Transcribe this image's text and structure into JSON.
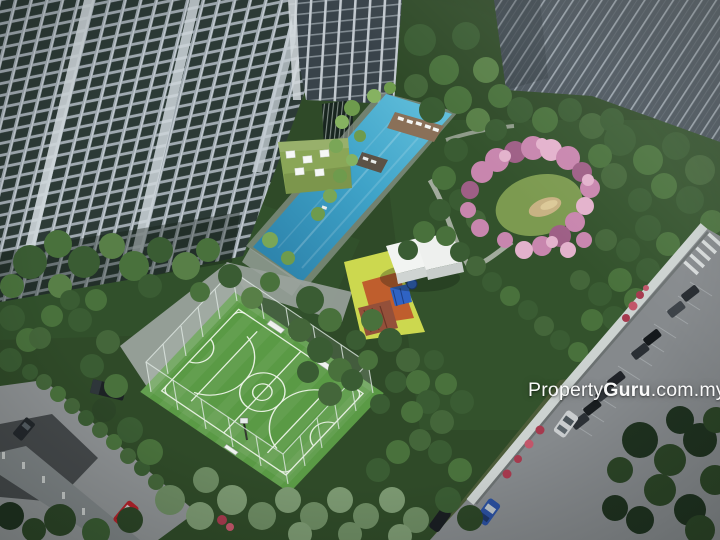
{
  "watermark": {
    "property": "Property",
    "guru": "Guru",
    "suffix": ".com.my"
  },
  "scene": {
    "type": "aerial-architectural-render",
    "description": "Aerial 3D render of a condominium facilities podium: residential towers, diagonal lap pool with sun deck, rooftop terrace with white cabanas, heart-shaped pink blossom garden with sand mound, playground with pavilions, fenced green futsal/basketball court, all ringed by trees and access roads with parked cars",
    "objects": [
      "residential-towers",
      "lap-pool",
      "sun-deck",
      "rooftop-terrace",
      "cabanas",
      "futsal-basketball-court",
      "chain-link-fence",
      "goal-benches",
      "basketball-hoop",
      "playground",
      "clubhouse-pavilions",
      "blossom-garden",
      "sand-mound",
      "boundary-wall",
      "access-roads",
      "zebra-crossing",
      "parked-cars",
      "flower-beds",
      "trees"
    ],
    "colors": {
      "pool": "#3fa3c8",
      "pool_deep": "#2e85ad",
      "court_turf": "#5a9a45",
      "court_lines": "#edf4e8",
      "blossom": "#c886ae",
      "tree": "#3a5c33",
      "tree_dark": "#24381f",
      "facade": "#a9b3ba",
      "glass": "#2c3a36",
      "road": "#8e9294",
      "terrace_lawn": "#8aa657",
      "playground_yellow": "#ccd84f",
      "playground_orange": "#bf5e2d",
      "accent_blue": "#2f63c4",
      "car_red": "#b1222a",
      "car_blue": "#2a4f9e",
      "flower_red": "#a63a4e"
    }
  }
}
